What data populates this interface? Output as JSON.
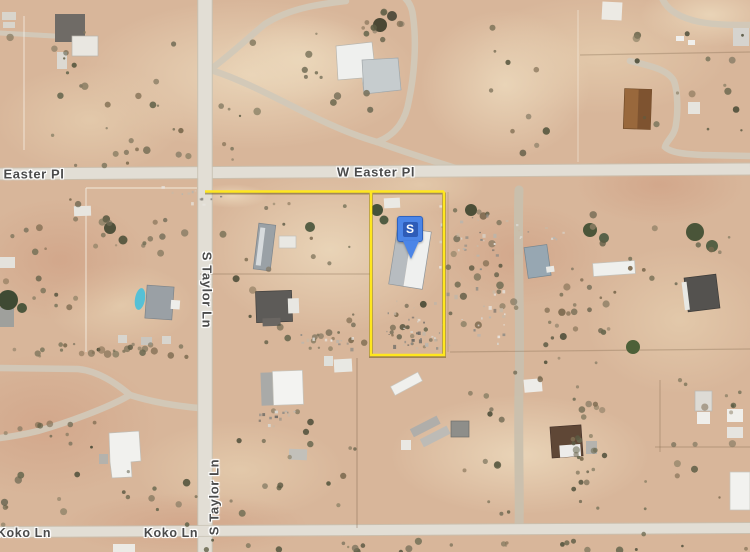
{
  "map": {
    "labels": {
      "easter_pl": "Easter Pl",
      "w_easter_pl": "W Easter Pl",
      "s_taylor_upper": "S Taylor Ln",
      "s_taylor_lower": "S Taylor Ln",
      "koko_left": "Koko Ln",
      "koko_center": "Koko Ln"
    },
    "marker": {
      "label": "S",
      "pin_color": "#4b85e7",
      "inner_color": "#2e5cb7"
    },
    "parcel": {
      "outline_color": "#ffe71f"
    },
    "colors": {
      "terrain_base": "#d8b69a",
      "paved_road": "#e2ded5",
      "dirt_road": "#d2c9b9",
      "label_text": "#4b4b4b",
      "vegetation": "#5c5b43",
      "pool": "#56c0d6"
    }
  }
}
